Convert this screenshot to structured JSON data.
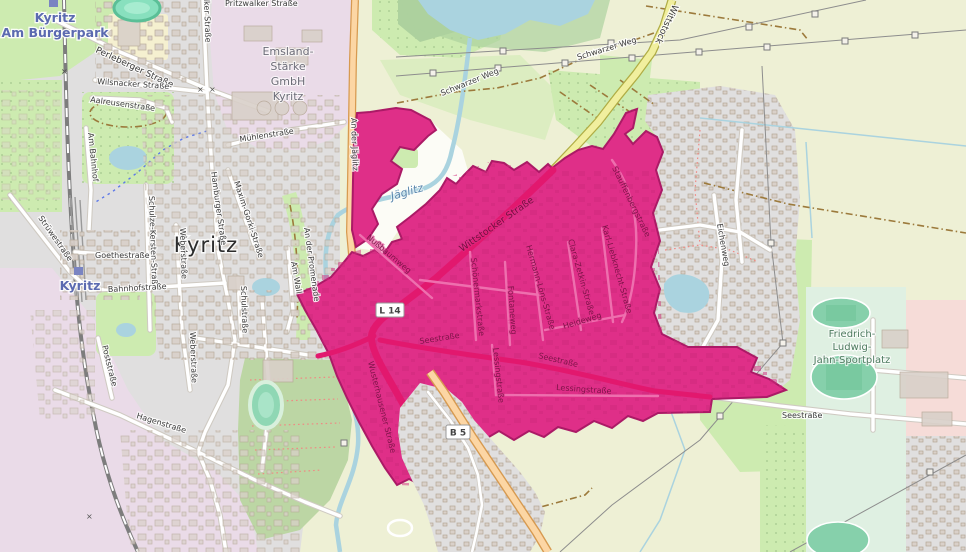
{
  "map": {
    "places": {
      "city": "Kyritz"
    },
    "transit": {
      "halt_line1": "Kyritz",
      "halt_line2": "Am Bürgerpark",
      "station": "Kyritz"
    },
    "areas": {
      "emsland_lines": [
        "Emsland-",
        "Stärke",
        "GmbH",
        "Kyritz"
      ],
      "sportplatz_lines": [
        "Friedrich-",
        "Ludwig-",
        "Jahn-Sportplatz"
      ]
    },
    "water": {
      "river": "Jäglitz"
    },
    "shields": {
      "l14": "L 14",
      "b5": "B 5"
    },
    "streets": {
      "pritzwalker": "Pritzwalker Straße",
      "perleberger": "Perleberger Straße",
      "wilsnacker": "Wilsnacker Straße",
      "aalreusen": "Aalreusenstraße",
      "muehlen": "Mühlenstraße",
      "hamburger": "Hamburger Straße",
      "maxim_gorki": "Maxim-Gorki-Straße",
      "schulze_kersten": "Schulze-Kersten-Straße",
      "weber": "Weberstraße",
      "goethe": "Goethestraße",
      "bahnhof": "Bahnhofstraße",
      "schul": "Schulstraße",
      "am_wall": "Am Wall",
      "promenade": "An der Promenade",
      "am_bahnhof": "Am Bahnhof",
      "struewe": "Strüwestraße",
      "hagen": "Hagenstraße",
      "post": "Poststraße",
      "an_der_jaeglitz": "An der Jäglitz",
      "schwarzer_weg": "Schwarzer Weg",
      "wittstock": "Wittstock",
      "wittstocker": "Wittstocker Straße",
      "nussbaum": "Nußbaumweg",
      "schoenermark": "Schönermarkstraße",
      "fontane": "Fontaneweg",
      "hermann_loens": "Hermann-Löns-Straße",
      "clara_zetkin": "Clara-Zetkin-Straße",
      "karl_liebknecht": "Karl-Liebknecht-Straße",
      "stauffenberg": "Stauffenbergstraße",
      "heide": "Heideweg",
      "see": "Seestraße",
      "lessing": "Lessingstraße",
      "wusterhausener": "Wusterhausener Straße",
      "eichen": "Eichenweg"
    },
    "colors": {
      "highlight": "#df2f88",
      "highlight_border": "#ab1a66",
      "highlight_road": "#e2186e",
      "water": "#aad3df",
      "farmland": "#eef0d5",
      "grass": "#cdebb0",
      "forest": "#add19e",
      "residential": "#e0dfdf",
      "industrial": "#eadbe8",
      "school_pink": "#f6dcd8",
      "sports_mint": "#dff0e2",
      "road_orange": "#fcd6a4",
      "road_yellow": "#f1ef9e",
      "building": "#d9d0c9"
    }
  }
}
